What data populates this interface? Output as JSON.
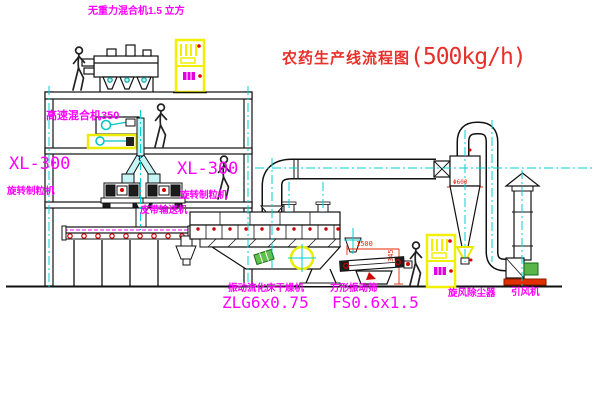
{
  "title": {
    "name": "农药生产线流程图",
    "capacity": "(500kg/h)"
  },
  "equipment_labels": {
    "gravity_mixer": "无重力混合机1.5 立方",
    "high_speed_mixer": "高速混合机350",
    "granulator_left_model": "XL-300",
    "granulator_left_name": "旋转制粒机",
    "granulator_right_model": "XL-300",
    "granulator_right_name": "旋转制粒机",
    "belt_conveyor": "皮带输送机",
    "dryer_name": "振动流化床干燥机",
    "dryer_model": "ZLG6x0.75",
    "screen_name": "方形振动筛",
    "screen_model": "FS0.6x1.5",
    "cyclone": "旋风除尘器",
    "fan": "引风机"
  },
  "dimensions": {
    "screen_length": "1500",
    "screen_height": "345",
    "cyclone_diameter": "Φ600"
  },
  "colors": {
    "label_magenta": "#ff00ff",
    "title_red": "#e8302a",
    "dimension_red": "#e02800",
    "centerline_cyan": "#00d2d2",
    "highlight_yellow": "#f0f000",
    "line_black": "#111111"
  }
}
